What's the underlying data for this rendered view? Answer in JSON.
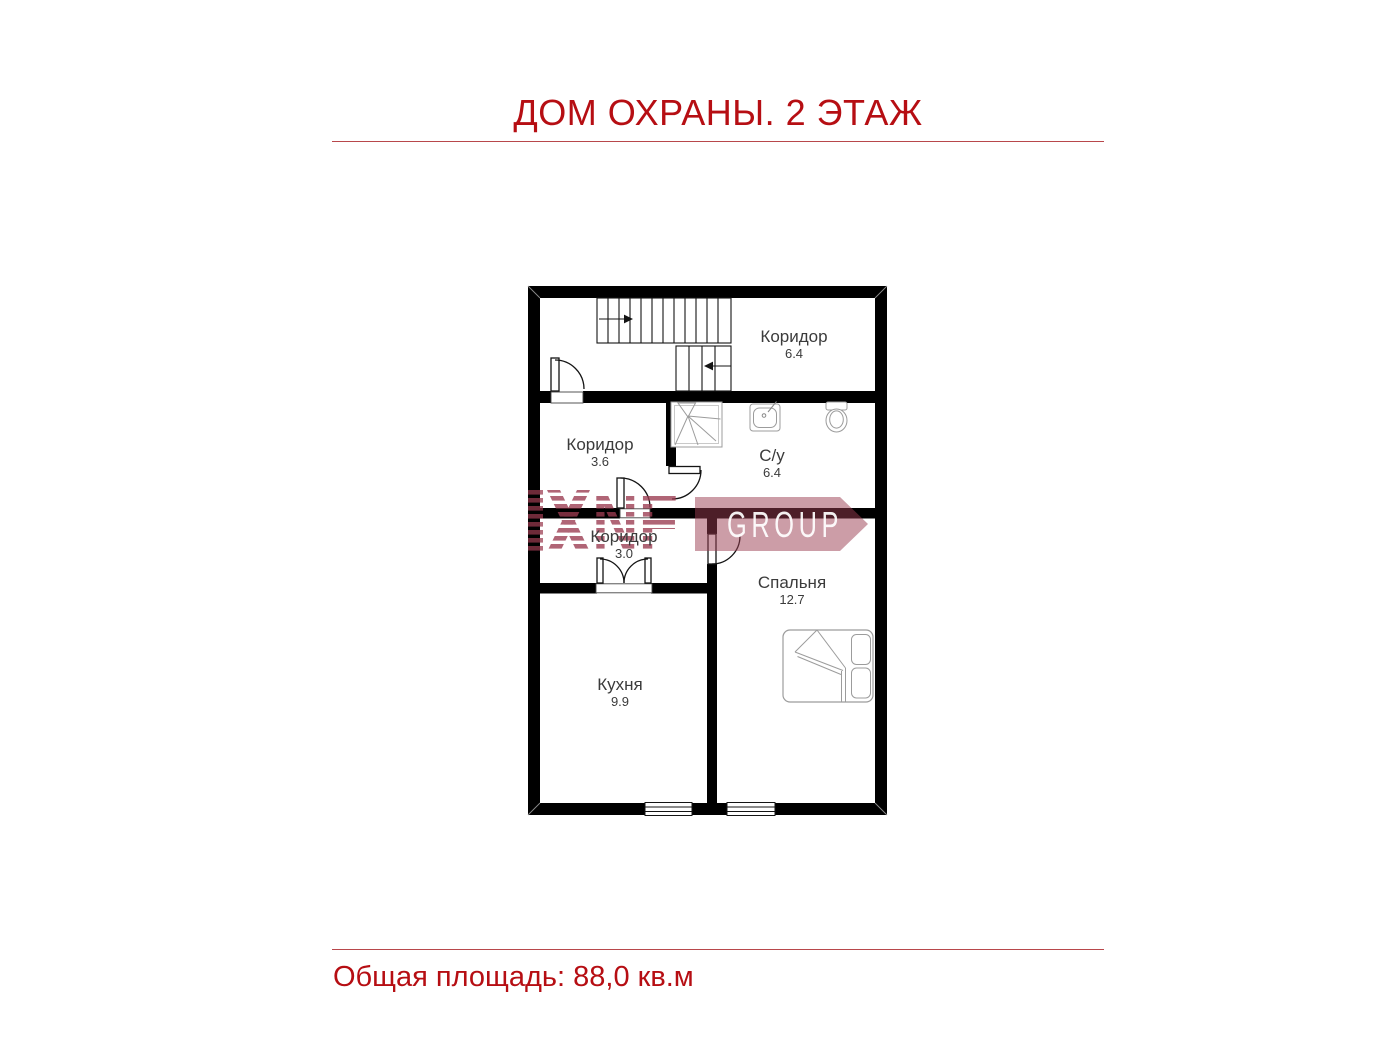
{
  "title": "ДОМ ОХРАНЫ. 2 ЭТАЖ",
  "footer": {
    "total_area": "Общая площадь: 88,0 кв.м"
  },
  "watermark": {
    "letters": "NF",
    "banner": "GROUP",
    "color": "#9a3b50"
  },
  "colors": {
    "accent_red": "#b60e13",
    "wall_black": "#000000",
    "fixture_gray": "#9c9c9c",
    "label_gray": "#3b3b3b"
  },
  "rooms": [
    {
      "id": "corridor-top",
      "name": "Коридор",
      "area": "6.4"
    },
    {
      "id": "corridor-mid",
      "name": "Коридор",
      "area": "3.6"
    },
    {
      "id": "bathroom",
      "name": "С/у",
      "area": "6.4"
    },
    {
      "id": "corridor-small",
      "name": "Коридор",
      "area": "3.0"
    },
    {
      "id": "bedroom",
      "name": "Спальня",
      "area": "12.7"
    },
    {
      "id": "kitchen",
      "name": "Кухня",
      "area": "9.9"
    }
  ],
  "plan": {
    "fixtures": [
      "staircase-up-arrow",
      "staircase-down-arrow",
      "door-swing",
      "double-door",
      "shower",
      "sink",
      "toilet",
      "double-bed",
      "window"
    ]
  }
}
